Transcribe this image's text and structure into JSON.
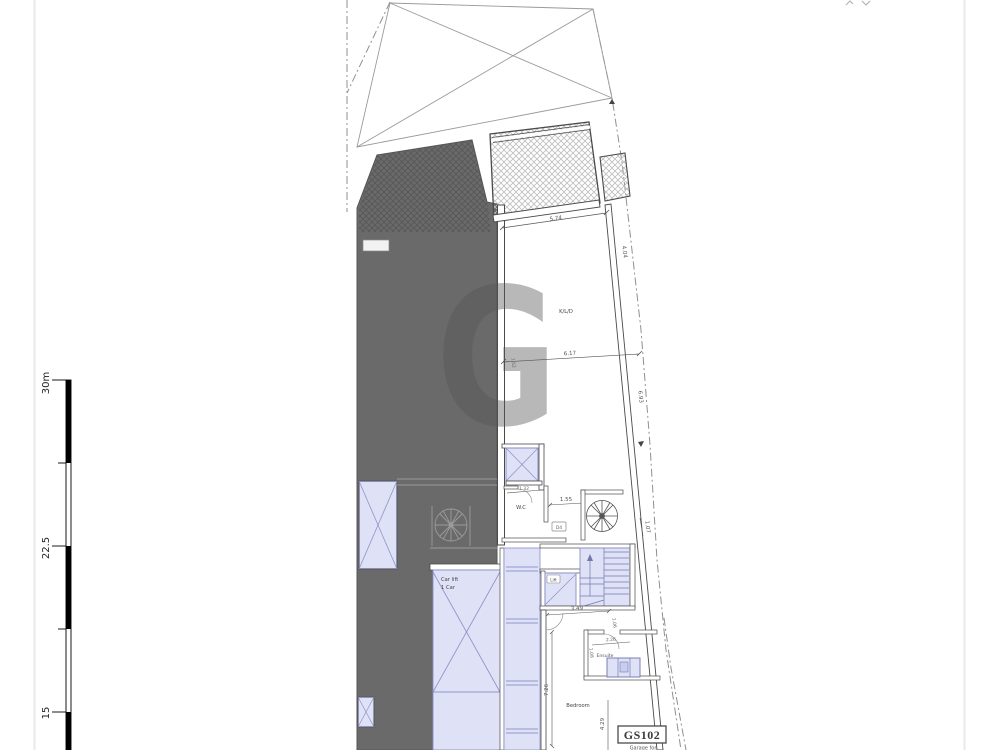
{
  "document": {
    "kind": "architectural-floor-plan"
  },
  "colors": {
    "mass_dark": "#6a6a6a",
    "mass_hatch": "#575757",
    "lavender_fill": "#dfe2f7",
    "lavender_border": "#8a8ec5",
    "wall": "#4a4a4a",
    "boundary": "#909090",
    "watermark": "#ed7861",
    "sheet_edge": "#e9e9e9"
  },
  "watermark": {
    "letter": "G"
  },
  "scale_bar": {
    "top_label": "30m",
    "mid_label": "22.5",
    "bottom_label": "15"
  },
  "rooms": {
    "kld": "K/L/D",
    "wc": "W.C",
    "car_lift_line1": "Car lift",
    "car_lift_line2": "1 Car",
    "lift": "Lift",
    "ensuite": "Ensuite",
    "bedroom": "Bedroom"
  },
  "tags": {
    "unit": "GS102",
    "unit_sub": "Garage for",
    "door": "D4"
  },
  "dimensions": {
    "top": "5.74",
    "mid": "6.17",
    "right_upper": "4.04",
    "right_lower": "6.93",
    "left_wall": "1.52",
    "shaft": "1.32",
    "wc": "1.55",
    "stair_side": "1.07",
    "corridor": "3.49",
    "stair_bottom": "1.06",
    "ensuite_w": "2.26",
    "ensuite_h": "1.08",
    "bedroom_h": "7.26",
    "bedroom_r": "4.29"
  }
}
